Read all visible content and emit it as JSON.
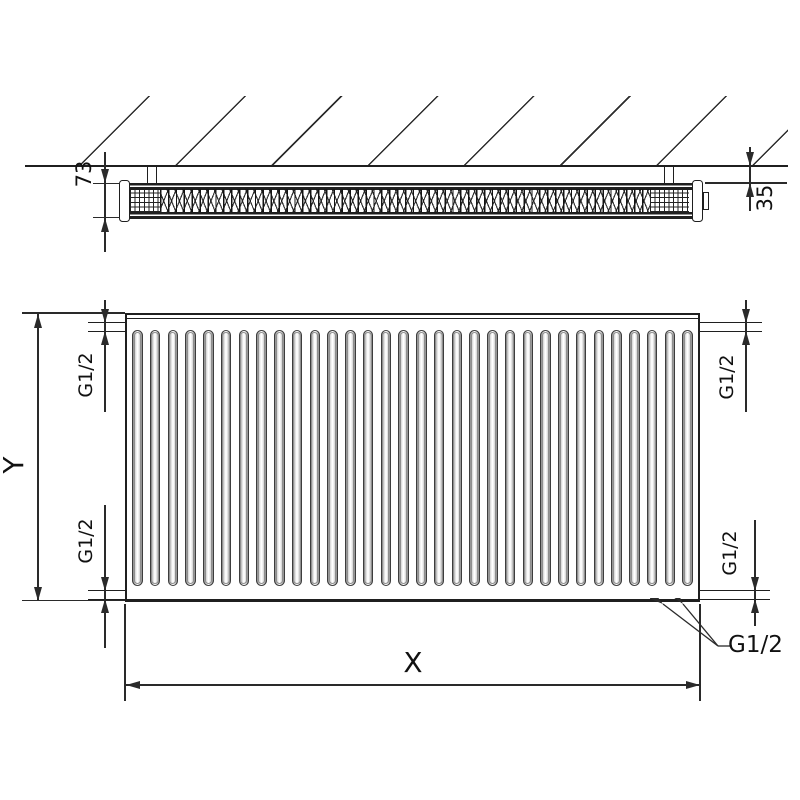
{
  "top_view": {
    "depth_label": "73",
    "wall_gap_label": "35"
  },
  "front_view": {
    "height_label": "Y",
    "width_label": "X",
    "channel_count": 32,
    "connections": {
      "top_left": "G1/2",
      "bottom_left": "G1/2",
      "top_right": "G1/2",
      "bottom_right": "G1/2",
      "bottom_leader": "G1/2"
    }
  },
  "colors": {
    "line": "#1f1f1f",
    "background": "#ffffff"
  }
}
